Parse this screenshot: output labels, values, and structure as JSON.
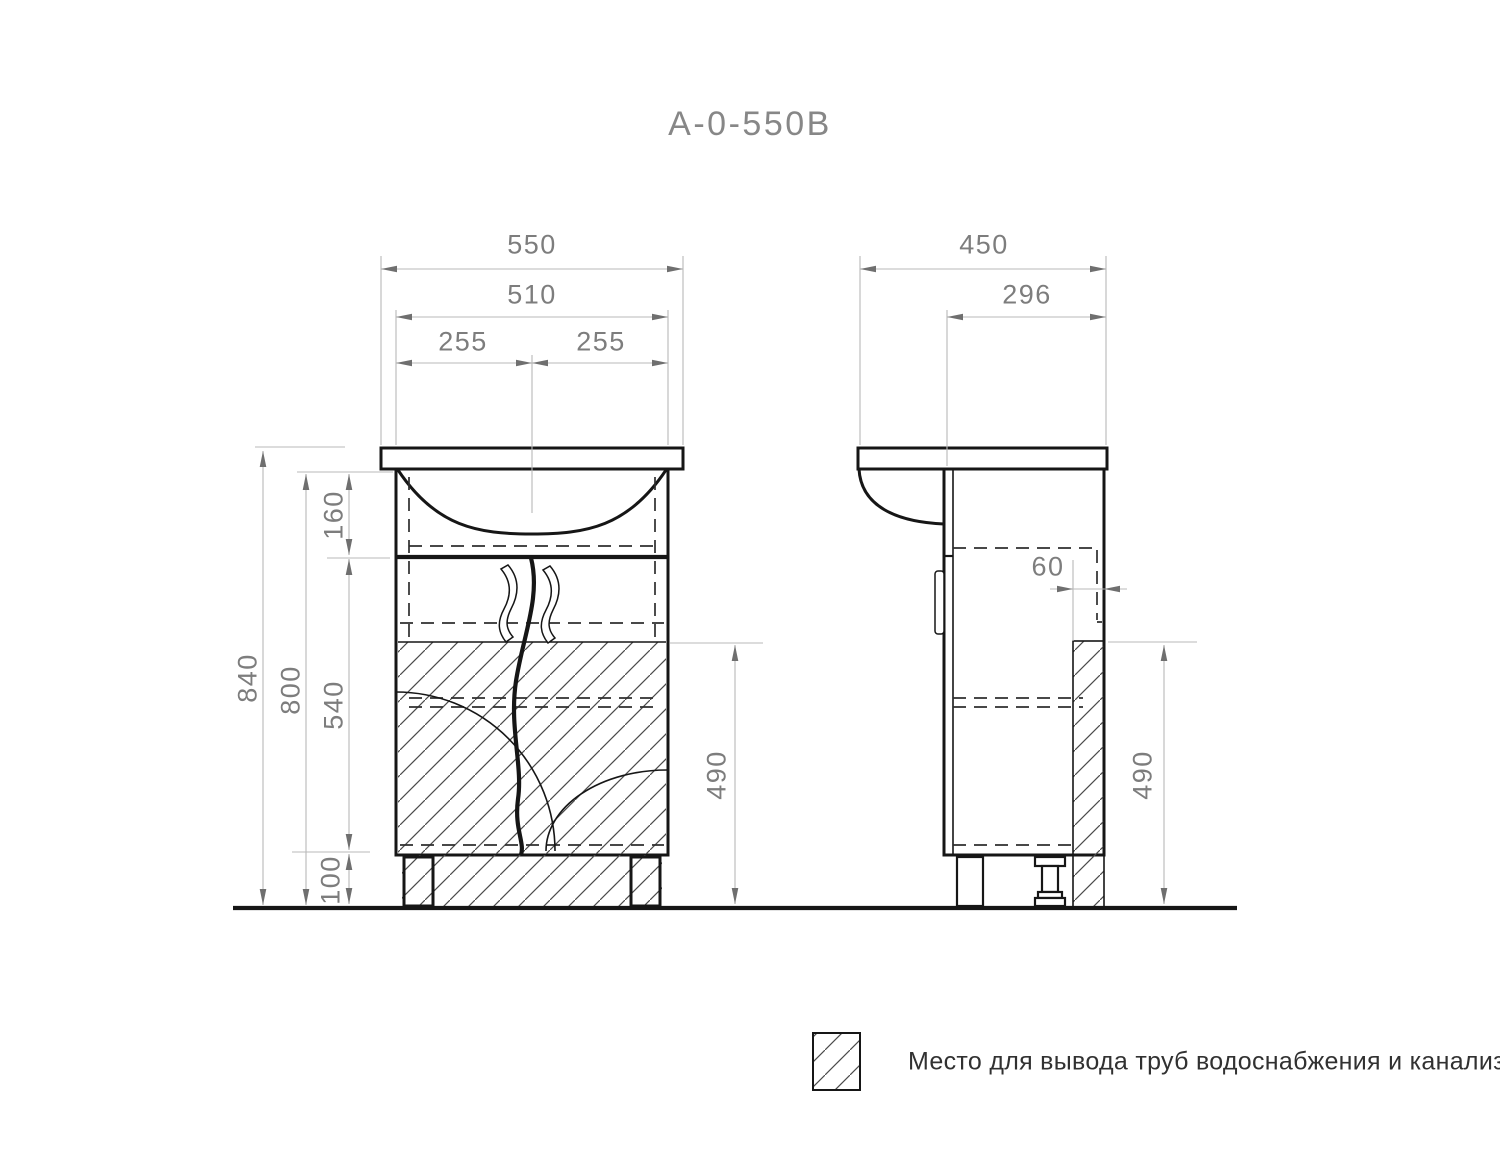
{
  "title": "A-0-550B",
  "dimensions": {
    "front": {
      "total_width": "550",
      "cabinet_width": "510",
      "left_half": "255",
      "right_half": "255",
      "total_height": "840",
      "cabinet_height": "800",
      "top_section_height": "160",
      "door_section_height": "540",
      "leg_height": "100",
      "pipe_zone_height": "490"
    },
    "side": {
      "total_depth": "450",
      "cabinet_depth": "296",
      "pipe_zone_offset": "60",
      "pipe_zone_height": "490"
    }
  },
  "legend": {
    "text": "Место для вывода труб водоснабжения и канализации"
  },
  "colors": {
    "line": "#161616",
    "hidden_line": "#2e2e2e",
    "dimension_line": "#b9b9b9",
    "dimension_text": "#7d7d7d",
    "title_text": "#878787",
    "hatch": "#4a4a4a"
  }
}
